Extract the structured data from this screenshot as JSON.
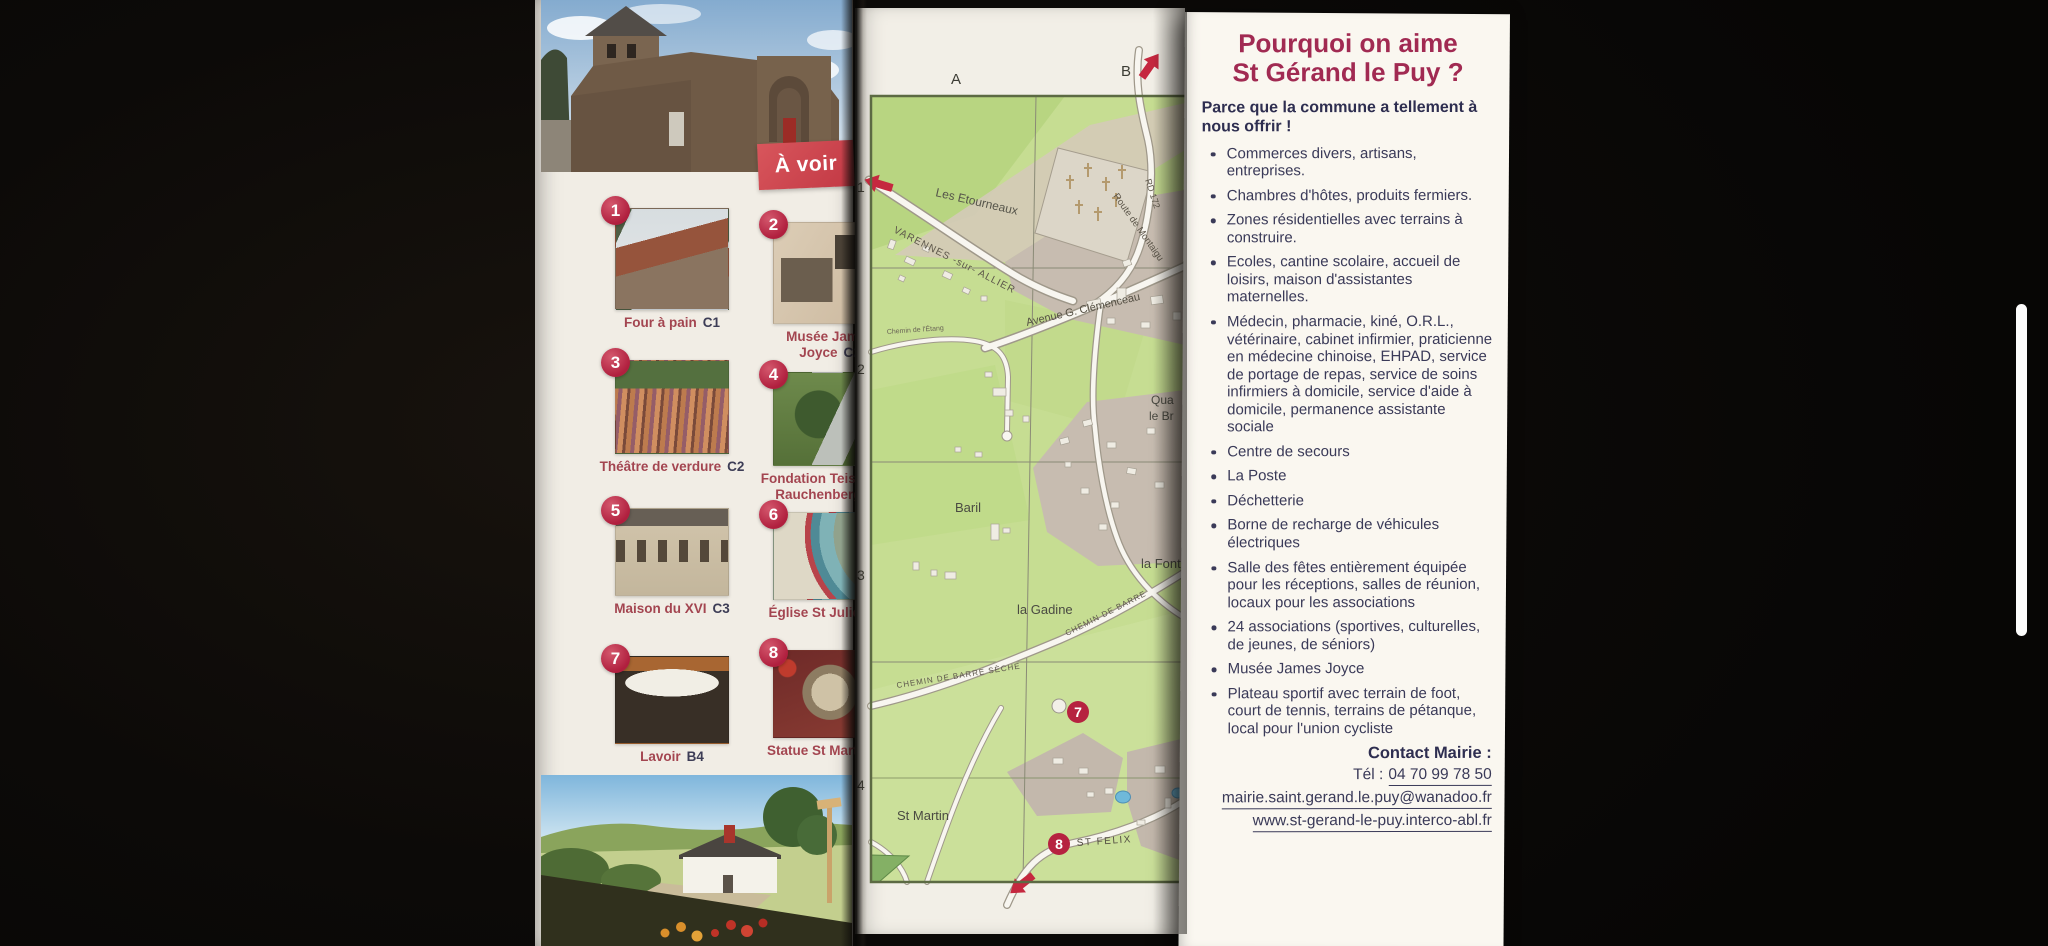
{
  "left_panel": {
    "a_voir_label": "À voir",
    "items": [
      {
        "num": "1",
        "name": "Four à pain",
        "ref": "C1"
      },
      {
        "num": "2",
        "name": "Musée James Joyce",
        "ref": "C2"
      },
      {
        "num": "3",
        "name": "Théâtre de verdure",
        "ref": "C2"
      },
      {
        "num": "4",
        "name": "Fondation Teissier de Rauchenberg",
        "ref": "C2"
      },
      {
        "num": "5",
        "name": "Maison du XVI",
        "ref": "C3"
      },
      {
        "num": "6",
        "name": "Église St Julien",
        "ref": "C3"
      },
      {
        "num": "7",
        "name": "Lavoir",
        "ref": "B4"
      },
      {
        "num": "8",
        "name": "Statue St Martin",
        "ref": "C3"
      }
    ]
  },
  "map": {
    "grid": {
      "cols": [
        "A",
        "B"
      ],
      "rows": [
        "1",
        "2",
        "3",
        "4"
      ]
    },
    "roads": {
      "varennes": "VARENNES -sur- ALLIER",
      "rd172": "RD 172",
      "montaigu": "Route de Montaigu",
      "clemenceau": "Avenue G. Clémenceau",
      "etang": "Chemin de l'Étang",
      "barre_seche": "CHEMIN DE BARRE SÈCHE",
      "barre": "CHEMIN DE BARRE",
      "st_felix": "ST FELIX"
    },
    "places": {
      "etourneaux": "Les Etourneaux",
      "baril": "Baril",
      "gadine": "la Gadine",
      "font": "la Font",
      "qua": "Qua",
      "le_br": "le Br",
      "st_martin": "St Martin"
    },
    "markers": {
      "m7": "7",
      "m8": "8"
    }
  },
  "right_panel": {
    "title_line1": "Pourquoi on aime",
    "title_line2": "St Gérand le Puy ?",
    "intro": "Parce que la commune a tellement à nous offrir !",
    "bullets": [
      "Commerces divers, artisans, entreprises.",
      "Chambres d'hôtes, produits fermiers.",
      "Zones résidentielles avec terrains à construire.",
      "Ecoles, cantine scolaire, accueil de loisirs, maison d'assistantes maternelles.",
      "Médecin, pharmacie, kiné, O.R.L., vétérinaire, cabinet infirmier, praticienne en médecine chinoise, EHPAD, service de portage de repas, service de soins infirmiers à domicile, service d'aide à domicile, permanence assistante sociale",
      "Centre de secours",
      "La Poste",
      "Déchetterie",
      "Borne de recharge de véhicules électriques",
      "Salle des fêtes entièrement équipée pour les réceptions, salles de réunion, locaux pour les associations",
      "24 associations (sportives, culturelles, de jeunes, de séniors)",
      "Musée James Joyce",
      "Plateau sportif avec terrain de foot, court de tennis, terrains de pétanque, local pour l'union cycliste"
    ],
    "contact": {
      "heading": "Contact Mairie :",
      "phone_label": "Tél :",
      "phone": "04 70 99 78 50",
      "email": "mairie.saint.gerand.le.puy@wanadoo.fr",
      "website": "www.st-gerand-le-puy.interco-abl.fr"
    }
  },
  "colors": {
    "accent_red": "#c2304a",
    "banner_red": "#d24b53",
    "title_maroon": "#a12a52",
    "text_navy": "#3a3a58",
    "map_green": "#c6dd92",
    "paper": "#f7f4ed"
  }
}
